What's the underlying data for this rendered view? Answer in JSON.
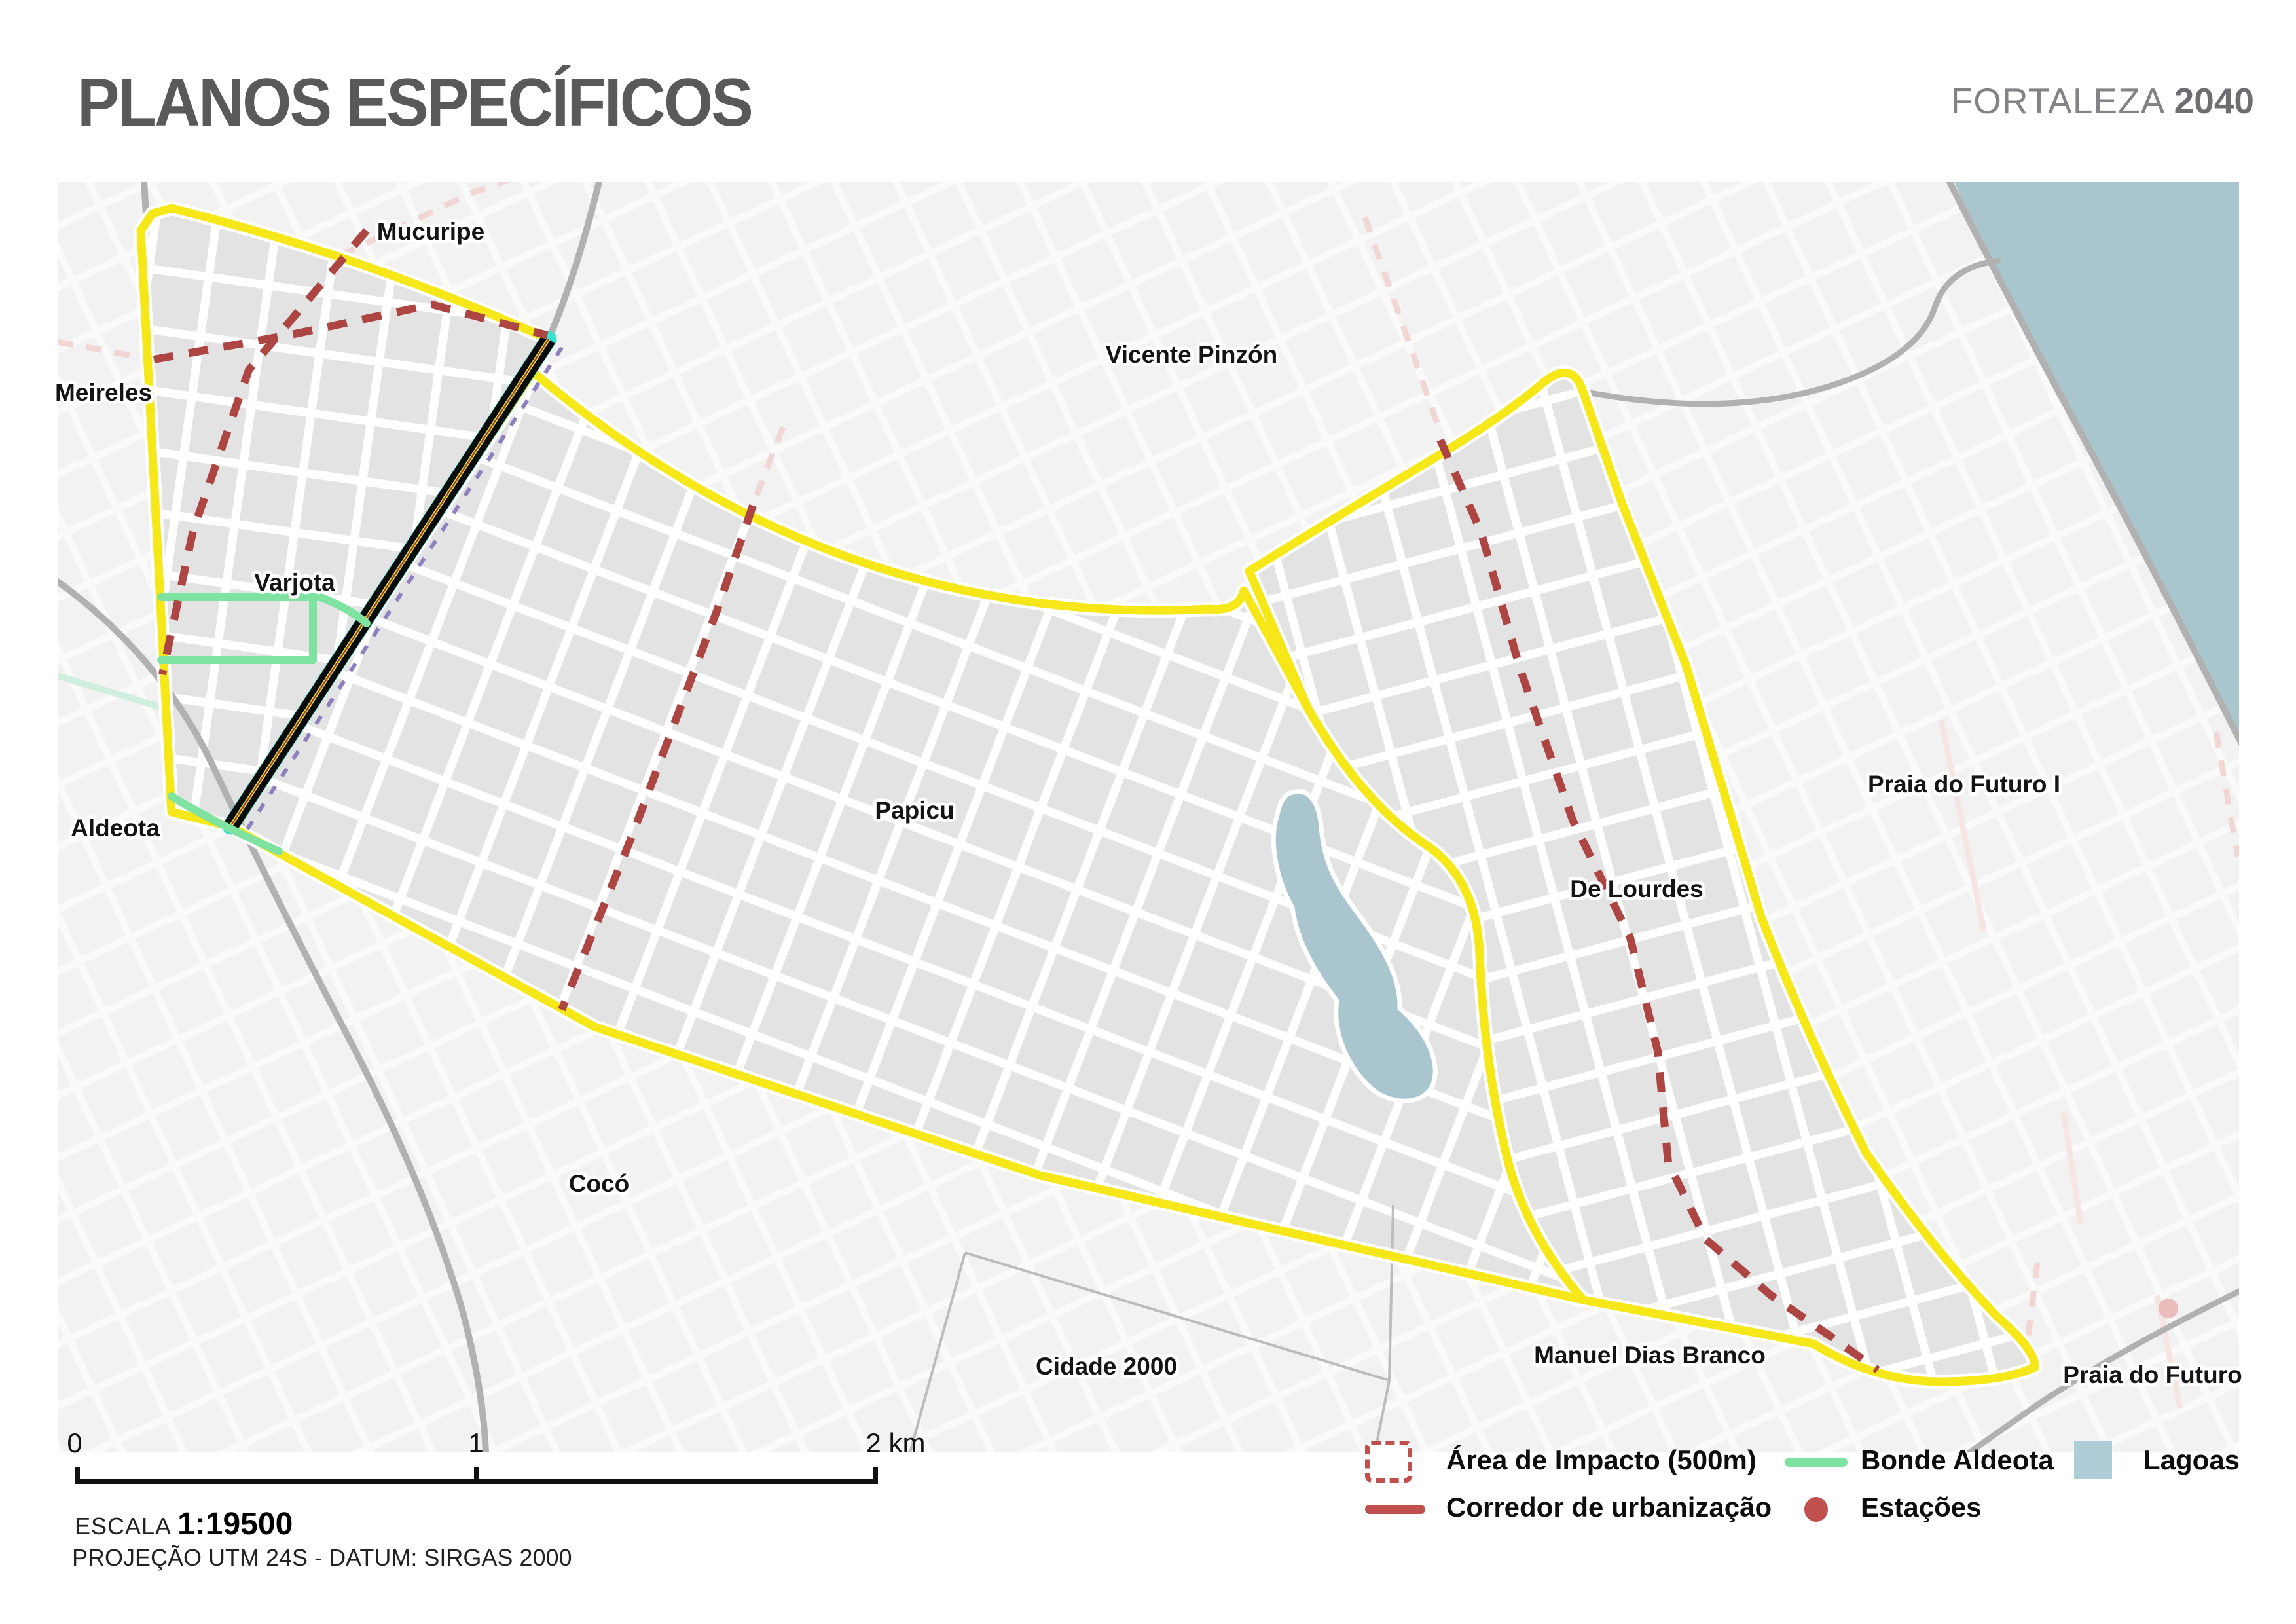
{
  "header": {
    "title": "PLANOS ESPECÍFICOS",
    "brand_name": "FORTALEZA",
    "brand_year": "2040"
  },
  "map": {
    "labels": [
      {
        "text": "Mucuripe"
      },
      {
        "text": "Meireles"
      },
      {
        "text": "Varjota"
      },
      {
        "text": "Vicente Pinzón"
      },
      {
        "text": "Aldeota"
      },
      {
        "text": "Papicu"
      },
      {
        "text": "De Lourdes"
      },
      {
        "text": "Praia do Futuro I"
      },
      {
        "text": "Cocó"
      },
      {
        "text": "Cidade 2000"
      },
      {
        "text": "Manuel Dias Branco"
      },
      {
        "text": "Praia do Futuro"
      }
    ],
    "features": {
      "boundary": "Planos Específicos area boundary",
      "railway": "rail corridor Varjota–Aldeota",
      "lagoon": "Lagoa do Papicu"
    }
  },
  "legend": {
    "items": [
      {
        "label": "Área de Impacto (500m)",
        "swatch": "dashed-square",
        "color": "#C0504D"
      },
      {
        "label": "Corredor de urbanização",
        "swatch": "red-line",
        "color": "#C0504D"
      },
      {
        "label": "Bonde Aldeota",
        "swatch": "green-line",
        "color": "#7EE2A0"
      },
      {
        "label": "Estações",
        "swatch": "dot",
        "color": "#C0504D"
      },
      {
        "label": "Lagoas",
        "swatch": "square",
        "color": "#AECDD6"
      }
    ]
  },
  "scalebar": {
    "tick0": "0",
    "tick1": "1",
    "tick2": "2 km",
    "escala_label": "ESCALA",
    "escala_value": "1:19500",
    "projection": "PROJEÇÃO UTM 24S - DATUM: SIRGAS 2000"
  },
  "colors": {
    "boundary_yellow": "#F6E818",
    "corridor_red": "#AD4543",
    "faded_pink": "#F1D6D4",
    "bonde_green": "#7EE2A0",
    "water_blue": "#A9C6CE",
    "rail_cyan": "#3AE1CF",
    "rail_black": "#0A0A0A",
    "purple_dash": "#8D7FC0",
    "plan_fill": "#E4E3E3",
    "outside_fill": "#F3F2F2"
  }
}
